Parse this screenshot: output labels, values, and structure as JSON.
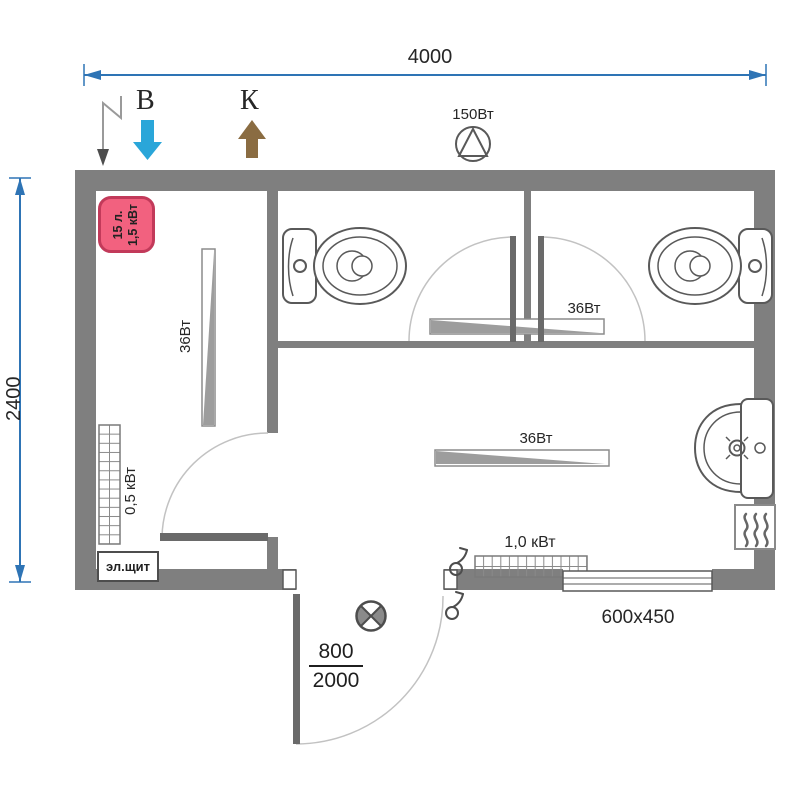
{
  "plan": {
    "title": "sanitary cabin floor plan",
    "width_label": "4000",
    "height_label": "2400",
    "water_supply_label": "В",
    "sewage_label": "К",
    "fan_power_label": "150Вт",
    "boiler_volume_label": "15 л.",
    "boiler_power_label": "1,5 кВт",
    "lamp_utility_label": "36Вт",
    "lamp_wc_label": "36Вт",
    "lamp_main_label": "36Вт",
    "heater_utility_label": "0,5 кВт",
    "heater_main_label": "1,0 кВт",
    "electrical_panel_label": "эл.щит",
    "window_size_label": "600x450",
    "door_width_label": "800",
    "door_height_label": "2000"
  },
  "icons": {
    "power_input": "lightning-arrow",
    "water_supply": "blue-arrow-down",
    "sewage": "brown-arrow-up",
    "fan": "circle-with-triangle",
    "ceiling_lamp": "circle-with-cross",
    "hand_dryer": "box-with-waves",
    "switch": "circle-with-hook"
  },
  "colors": {
    "wall": "#7f7f7f",
    "dimension": "#2e74b5",
    "water_arrow": "#2aa6d9",
    "sewage_arrow": "#8a6c42",
    "boiler_fill": "#f2617f",
    "boiler_border": "#c23a5a",
    "outline": "#595959",
    "lamp_wedge": "#9d9d9d"
  }
}
